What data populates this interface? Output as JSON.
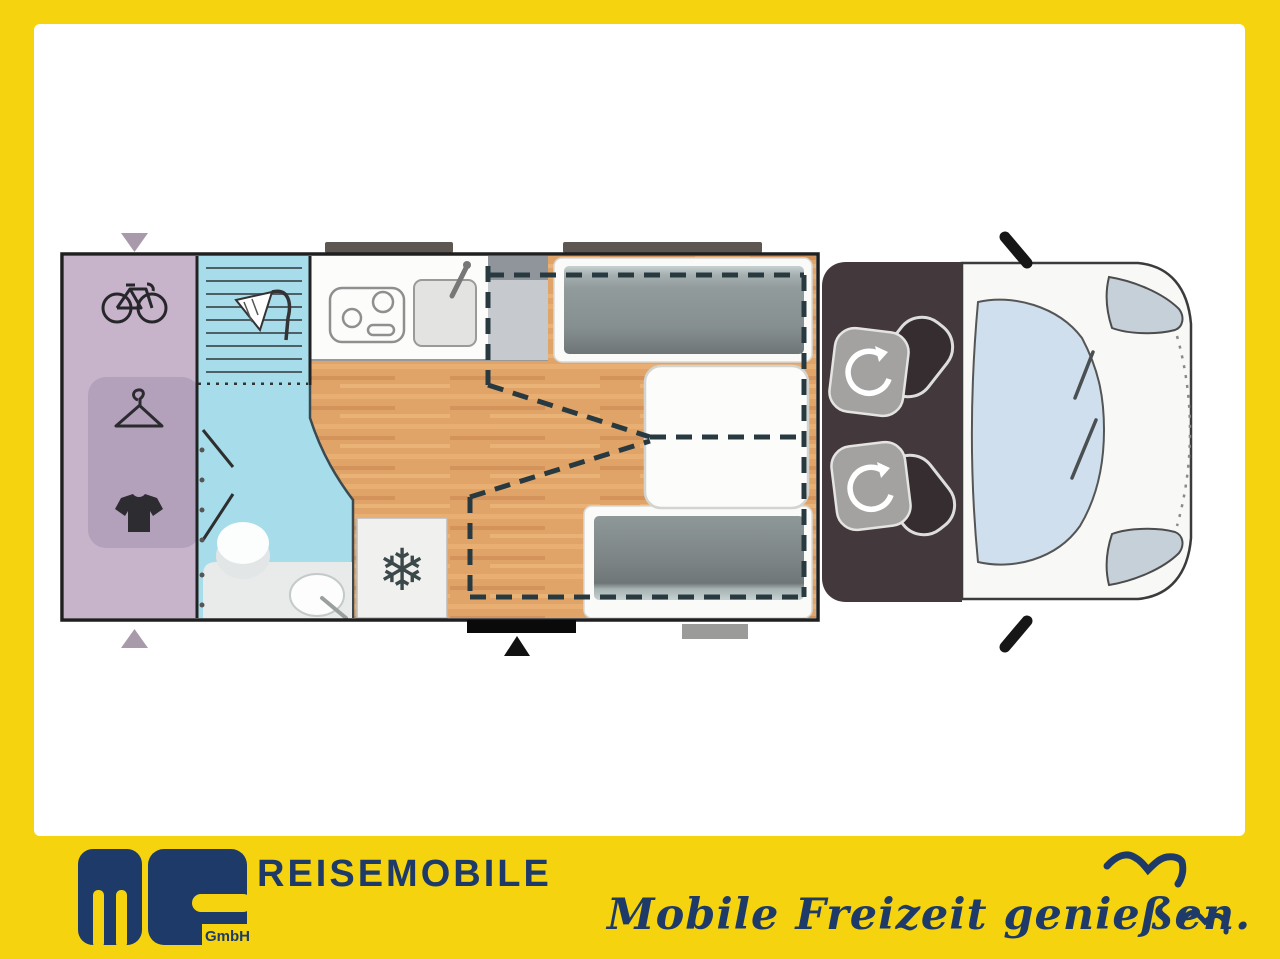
{
  "branding": {
    "logo": {
      "company_abbrev": "ms",
      "suffix": "GmbH"
    },
    "wordmark": "REISEMOBILE",
    "slogan": "Mobile Freizeit genießen."
  },
  "colors": {
    "frame-yellow": "#f5d40f",
    "brand-navy": "#1e3a69",
    "garage-purple": "#c7b4ca",
    "wardrobe-purple": "#b3a1bb",
    "bath-blue": "#a7dcea",
    "wood-floor": "#e1a468",
    "cushion-gray": "#8e9798",
    "cab-dark": "#43393d",
    "windshield-blue": "#d0dfee",
    "dashed-line": "#283a40"
  },
  "floorplan": {
    "icons": {
      "snowflake_char": "❄",
      "names": [
        "bicycle-icon",
        "hanger-icon",
        "tshirt-icon",
        "shower-icon",
        "hob-icon",
        "sink-icon",
        "snowflake-icon",
        "swivel-seat-icon",
        "door-marker",
        "roof-vent"
      ]
    }
  }
}
